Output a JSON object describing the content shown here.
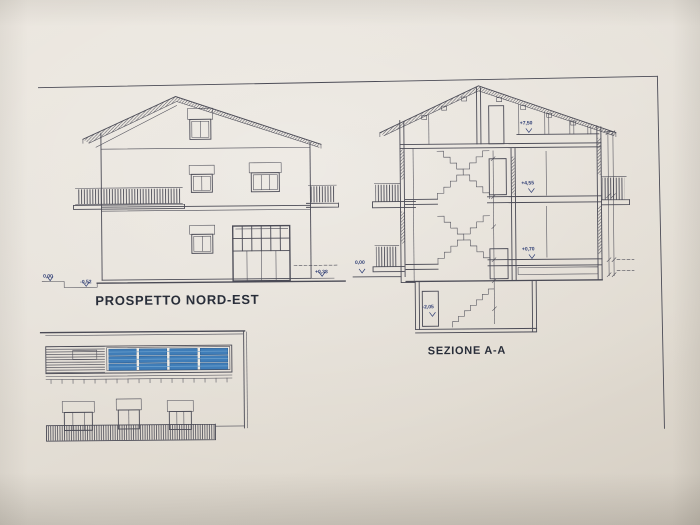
{
  "sheet": {
    "drawings": {
      "elevation_nordest": {
        "label": "PROSPETTO NORD-EST",
        "level_marks": {
          "zero": "0,00",
          "minus052": "-0,52",
          "plus038": "+0,38"
        }
      },
      "section_aa": {
        "label": "SEZIONE A-A",
        "level_marks": {
          "zero": "0,00",
          "plus750": "+7,50",
          "plus455": "+4,55",
          "plus070": "+0,70",
          "minus205": "-2,05"
        }
      }
    },
    "colors": {
      "paper": "#e5e0d7",
      "ink": "#4b4b56",
      "annotation_blue": "#2e3d74",
      "panel_blue": "#3f7db8"
    }
  }
}
